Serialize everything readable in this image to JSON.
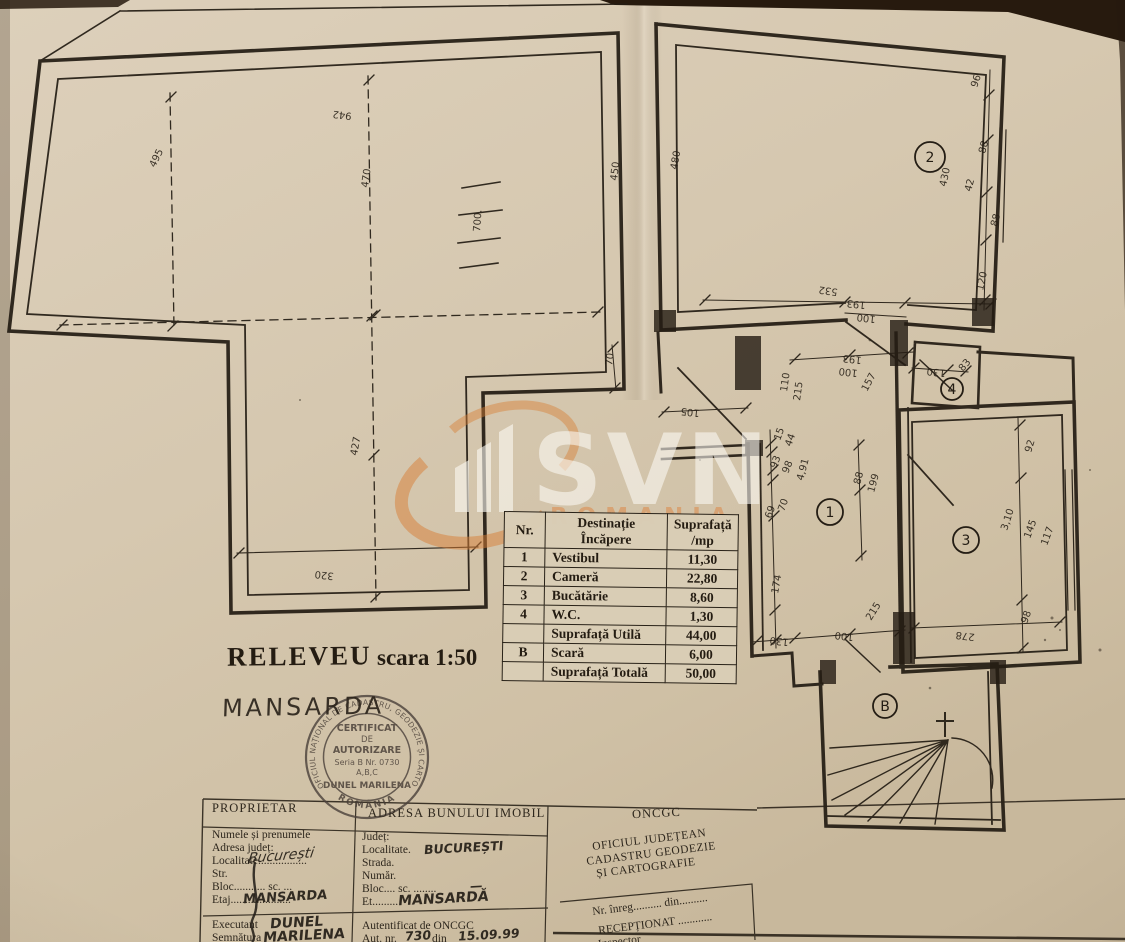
{
  "page": {
    "photo_background": "#2a1d10",
    "paper_color": "#d7c9b1",
    "ink_color": "#241d14",
    "watermark_accent": "#d77e35"
  },
  "watermark": {
    "brand": "SVN",
    "sub_brand": "ROMANIA"
  },
  "title_block": {
    "title": "RELEVEU",
    "scale": "scara 1:50",
    "floor_label": "MANSARDA"
  },
  "room_table": {
    "headers": {
      "nr": "Nr.",
      "dest_line1": "Destinație",
      "dest_line2": "Încăpere",
      "mp_line1": "Suprafață",
      "mp_line2": "/mp"
    },
    "rows": [
      [
        "1",
        "Vestibul",
        "11,30"
      ],
      [
        "2",
        "Cameră",
        "22,80"
      ],
      [
        "3",
        "Bucătărie",
        "8,60"
      ],
      [
        "4",
        "W.C.",
        "1,30"
      ],
      [
        "",
        "Suprafață Utilă",
        "44,00"
      ],
      [
        "B",
        "Scară",
        "6,00"
      ],
      [
        "",
        "Suprafață Totală",
        "50,00"
      ]
    ]
  },
  "stamp": {
    "ring_text": "OFICIUL NAȚIONAL DE CADASTRU, GEODEZIE ȘI CARTOGRAFIE",
    "ring_bottom": "ROMÂNIA",
    "line1": "CERTIFICAT",
    "line2": "DE",
    "line3": "AUTORIZARE",
    "line4": "Seria B Nr. 0730",
    "line5": "A,B,C",
    "line6": "DUNEL MARILENA"
  },
  "form": {
    "col1": {
      "header": "PROPRIETAR",
      "rows": [
        "Numele și prenumele",
        "Adresa județ:",
        "Localitate.................",
        "Str.",
        "Bloc........... sc. ...",
        "Etaj....................."
      ],
      "hw_localitate": "București",
      "hw_etaj": "MANSARDA",
      "executant_label": "Executant",
      "executant_value": "DUNEL",
      "semnatura_label": "Semnătura",
      "semnatura_value": "MARILENA"
    },
    "col2": {
      "header": "ADRESA BUNULUI IMOBIL",
      "rows": [
        "Județ:",
        "Localitate.",
        "Strada.",
        "Număr.",
        "Bloc.... sc. ........",
        "Et........."
      ],
      "hw_localitate": "BUCUREȘTI",
      "hw_bloc": "—",
      "hw_et": "MANSARDĂ",
      "autentificat": "Autentificat de ONCGC",
      "aut_label": "Aut. nr.",
      "aut_nr_value": "730",
      "aut_din_label": "din",
      "aut_din_value": "15.09.99"
    },
    "col3": {
      "header": "ONCGC",
      "office_line1": "OFICIUL JUDEȚEAN",
      "office_line2": "CADASTRU GEODEZIE",
      "office_line3": "ȘI CARTOGRAFIE",
      "nr_inreg": "Nr. înreg.......... din..........",
      "receptionat": "RECEPȚIONAT ............",
      "inspector": "Inspector"
    }
  },
  "plan": {
    "rooms": [
      {
        "n": "2",
        "x": 930,
        "y": 157,
        "rad": 15
      },
      {
        "n": "1",
        "x": 830,
        "y": 512,
        "rad": 13
      },
      {
        "n": "4",
        "x": 952,
        "y": 389,
        "rad": 11
      },
      {
        "n": "3",
        "x": 966,
        "y": 540,
        "rad": 13
      },
      {
        "n": "B",
        "x": 885,
        "y": 706,
        "rad": 12
      }
    ],
    "dimension_labels": [
      {
        "t": "942",
        "x": 352,
        "y": 113,
        "r": 187,
        "s": 13
      },
      {
        "t": "495",
        "x": 155,
        "y": 168,
        "r": -64,
        "s": 13
      },
      {
        "t": "470",
        "x": 368,
        "y": 188,
        "r": -82,
        "s": 13
      },
      {
        "t": "700.",
        "x": 480,
        "y": 232,
        "r": -86,
        "s": 13
      },
      {
        "t": "450",
        "x": 617,
        "y": 181,
        "r": -83,
        "s": 12
      },
      {
        "t": "480",
        "x": 677,
        "y": 170,
        "r": -80,
        "s": 12
      },
      {
        "t": "427",
        "x": 357,
        "y": 456,
        "r": -80,
        "s": 13
      },
      {
        "t": "320",
        "x": 334,
        "y": 573,
        "r": 186,
        "s": 13
      },
      {
        "t": "105",
        "x": 700,
        "y": 410,
        "r": 186,
        "s": 12
      },
      {
        "t": "70",
        "x": 612,
        "y": 366,
        "r": -82
      },
      {
        "t": "96",
        "x": 977,
        "y": 88,
        "r": -72
      },
      {
        "t": "88",
        "x": 985,
        "y": 154,
        "r": -75
      },
      {
        "t": "42",
        "x": 971,
        "y": 192,
        "r": -75
      },
      {
        "t": "88",
        "x": 997,
        "y": 227,
        "r": -75
      },
      {
        "t": "120",
        "x": 983,
        "y": 291,
        "r": -78
      },
      {
        "t": "430",
        "x": 946,
        "y": 187,
        "r": -78,
        "s": 12
      },
      {
        "t": "532",
        "x": 838,
        "y": 289,
        "r": 188,
        "s": 12
      },
      {
        "t": "193",
        "x": 866,
        "y": 302,
        "r": 186
      },
      {
        "t": "100",
        "x": 876,
        "y": 316,
        "r": 186
      },
      {
        "t": "193",
        "x": 862,
        "y": 357,
        "r": 186
      },
      {
        "t": "100",
        "x": 858,
        "y": 370,
        "r": 186
      },
      {
        "t": "157",
        "x": 867,
        "y": 392,
        "r": -62
      },
      {
        "t": "130",
        "x": 946,
        "y": 370,
        "r": 186
      },
      {
        "t": "83",
        "x": 963,
        "y": 372,
        "r": -50
      },
      {
        "t": "110",
        "x": 787,
        "y": 392,
        "r": -82
      },
      {
        "t": "215",
        "x": 800,
        "y": 401,
        "r": -82
      },
      {
        "t": "15",
        "x": 780,
        "y": 441,
        "r": -70
      },
      {
        "t": "44",
        "x": 791,
        "y": 447,
        "r": -70
      },
      {
        "t": "93",
        "x": 776,
        "y": 469,
        "r": -68
      },
      {
        "t": "98",
        "x": 788,
        "y": 474,
        "r": -68
      },
      {
        "t": "4,91",
        "x": 803,
        "y": 481,
        "r": -75
      },
      {
        "t": "88",
        "x": 860,
        "y": 485,
        "r": -75
      },
      {
        "t": "199",
        "x": 874,
        "y": 493,
        "r": -75
      },
      {
        "t": "70",
        "x": 784,
        "y": 512,
        "r": -70
      },
      {
        "t": "69",
        "x": 771,
        "y": 519,
        "r": -70
      },
      {
        "t": "174",
        "x": 778,
        "y": 594,
        "r": -80
      },
      {
        "t": "130",
        "x": 789,
        "y": 639,
        "r": 186
      },
      {
        "t": "100",
        "x": 854,
        "y": 634,
        "r": 186
      },
      {
        "t": "215",
        "x": 871,
        "y": 621,
        "r": -58
      },
      {
        "t": "92",
        "x": 1031,
        "y": 453,
        "r": -73
      },
      {
        "t": "3,10",
        "x": 1007,
        "y": 531,
        "r": -72,
        "s": 12
      },
      {
        "t": "145",
        "x": 1030,
        "y": 539,
        "r": -70
      },
      {
        "t": "117",
        "x": 1047,
        "y": 546,
        "r": -70
      },
      {
        "t": "98",
        "x": 1027,
        "y": 624,
        "r": -70
      },
      {
        "t": "278",
        "x": 975,
        "y": 634,
        "r": 187,
        "s": 12
      }
    ]
  }
}
